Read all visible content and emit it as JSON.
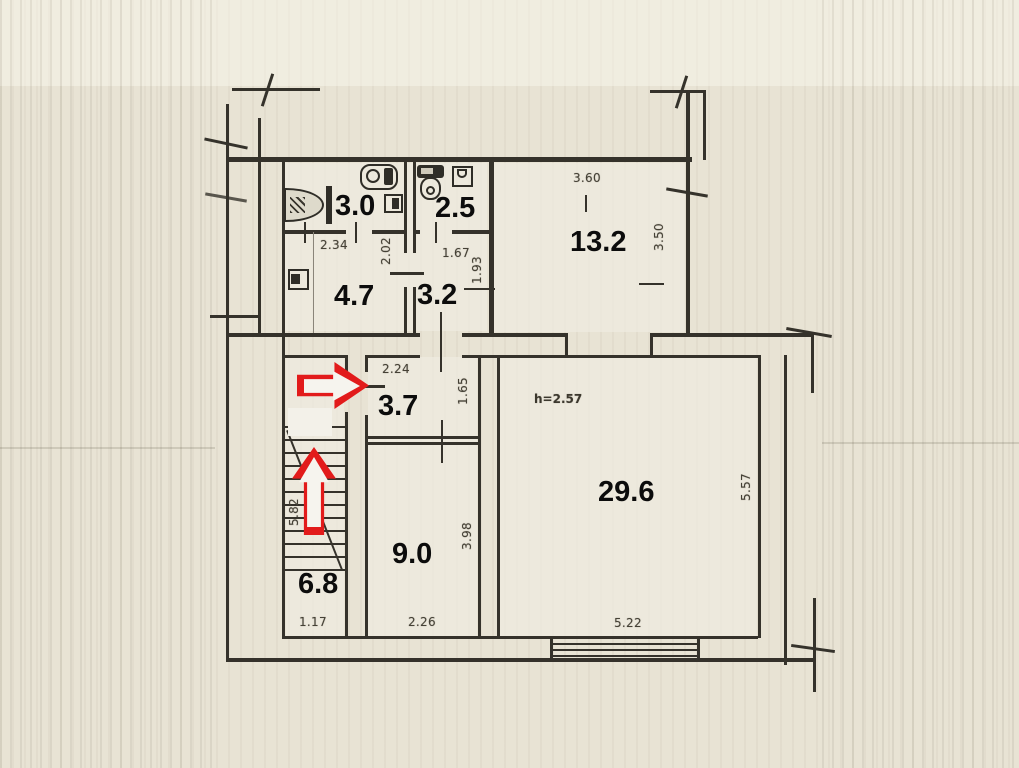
{
  "title": "apartment-floor-plan-scan",
  "colors": {
    "paper": "#e8e3d4",
    "line": "#35322b",
    "label": "#0c0c0c",
    "annotation_red": "#e21b1b"
  },
  "rooms": [
    {
      "name": "bathroom",
      "area": "3.0"
    },
    {
      "name": "wc",
      "area": "2.5"
    },
    {
      "name": "kitchen",
      "area": "13.2"
    },
    {
      "name": "hall-upper",
      "area": "4.7"
    },
    {
      "name": "corridor-upper",
      "area": "3.2"
    },
    {
      "name": "entry-hall",
      "area": "3.7"
    },
    {
      "name": "inner-room",
      "area": "9.0"
    },
    {
      "name": "living-room",
      "area": "29.6"
    },
    {
      "name": "staircase",
      "area": "6.8"
    }
  ],
  "dims": [
    "2.34",
    "2.02",
    "1.67",
    "1.93",
    "3.60",
    "3.50",
    "2.24",
    "1.65",
    "5.82",
    "1.17",
    "2.26",
    "3.98",
    "5.22",
    "5.57"
  ],
  "ceiling_height": "h=2.57",
  "annotations": {
    "arrows": [
      {
        "direction": "right",
        "meaning": "entrance-arrow",
        "color": "#e21b1b"
      },
      {
        "direction": "up",
        "meaning": "stairs-up-arrow",
        "color": "#e21b1b"
      }
    ]
  },
  "icons": [
    "shower-icon",
    "washing-machine-icon",
    "sink-icon",
    "toilet-icon",
    "wash-basin-icon",
    "cabinet-icon",
    "window-icon",
    "stairs-icon"
  ]
}
